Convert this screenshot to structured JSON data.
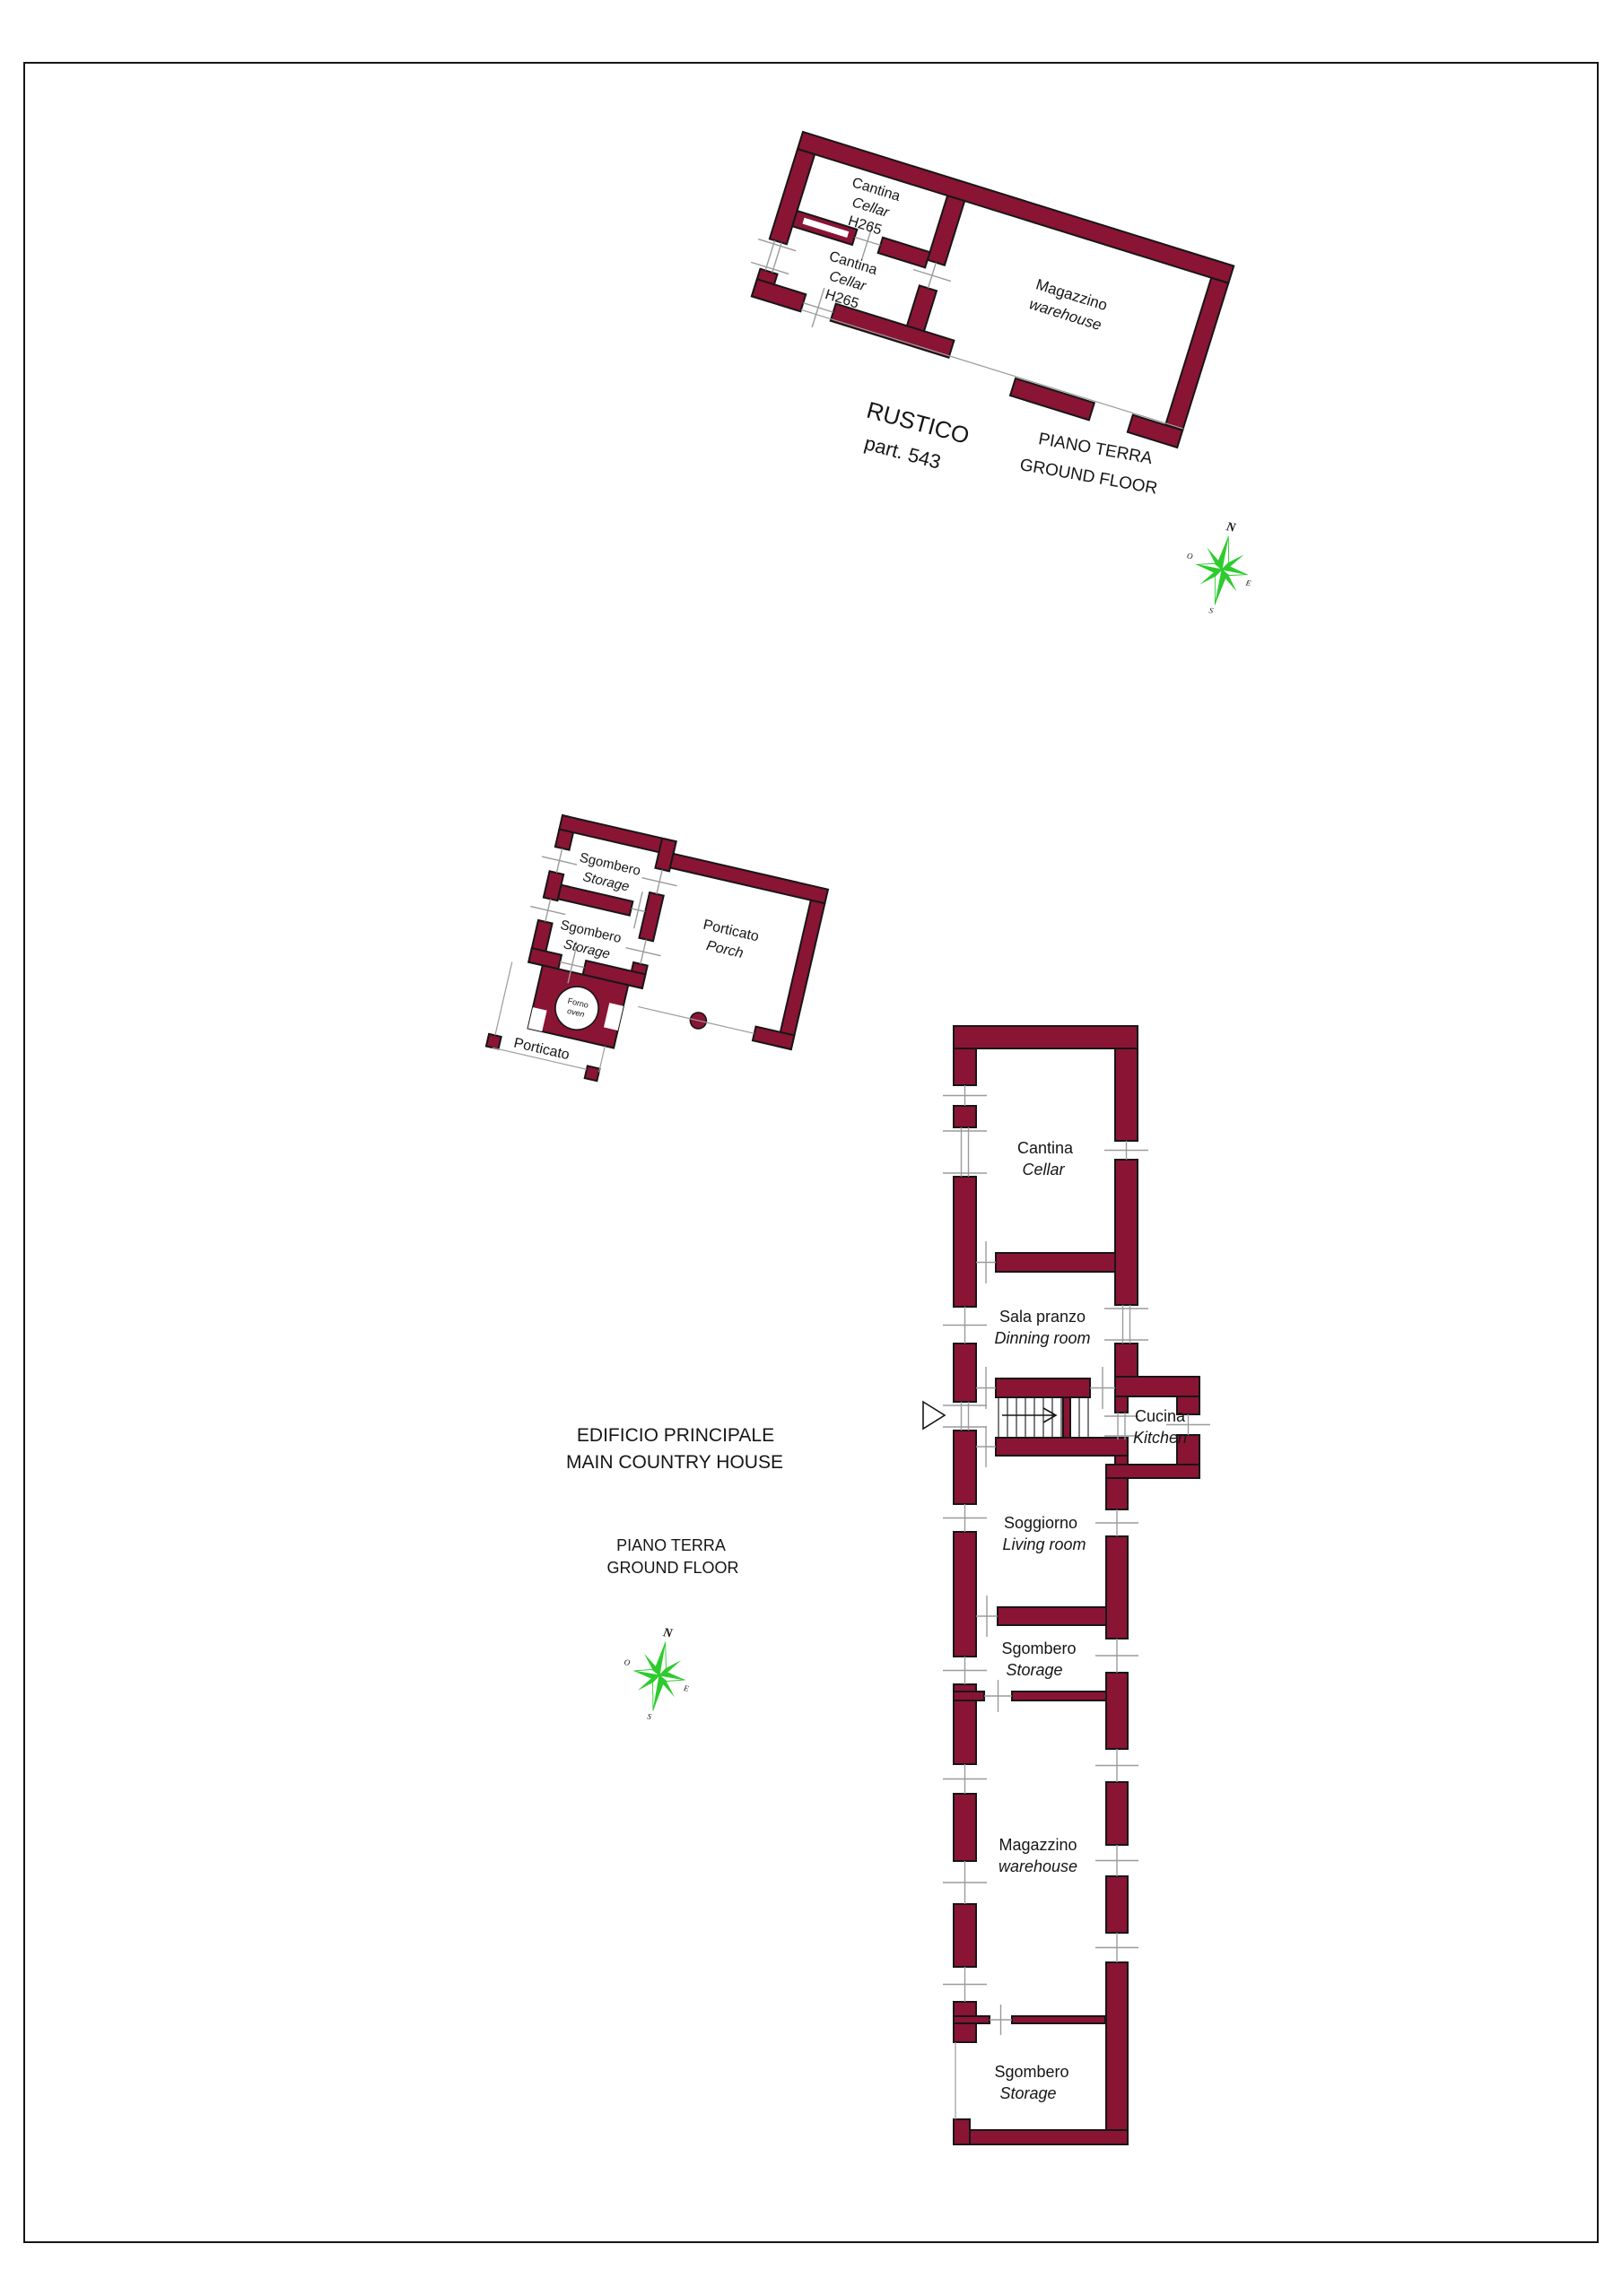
{
  "colors": {
    "wall": "#8a1434",
    "outline": "#161616",
    "thin_line": "#9b9b9b",
    "compass_green": "#2ecb2e",
    "text": "#161616"
  },
  "rustico": {
    "title": "RUSTICO",
    "parcel": "part. 543",
    "floor1": "PIANO TERRA",
    "floor2": "GROUND FLOOR",
    "cantina_upper": {
      "it": "Cantina",
      "en": "Cellar",
      "h": "H265"
    },
    "cantina_lower": {
      "it": "Cantina",
      "en": "Cellar",
      "h": "H265"
    },
    "magazzino": {
      "it": "Magazzino",
      "en": "warehouse"
    }
  },
  "outbuilding": {
    "storage_upper": {
      "it": "Sgombero",
      "en": "Storage"
    },
    "storage_lower": {
      "it": "Sgombero",
      "en": "Storage"
    },
    "porch": {
      "it": "Porticato",
      "en": "Porch"
    },
    "oven": {
      "it": "Forno",
      "en": "oven"
    },
    "porch_open": {
      "it": "Porticato"
    }
  },
  "main_house": {
    "title1": "EDIFICIO PRINCIPALE",
    "title2": "MAIN COUNTRY HOUSE",
    "floor1": "PIANO TERRA",
    "floor2": "GROUND FLOOR",
    "cantina": {
      "it": "Cantina",
      "en": "Cellar"
    },
    "sala_pranzo": {
      "it": "Sala pranzo",
      "en": "Dinning room"
    },
    "cucina": {
      "it": "Cucina",
      "en": "Kitchen"
    },
    "soggiorno": {
      "it": "Soggiorno",
      "en": "Living room"
    },
    "sgombero_mid": {
      "it": "Sgombero",
      "en": "Storage"
    },
    "magazzino": {
      "it": "Magazzino",
      "en": "warehouse"
    },
    "sgombero_bottom": {
      "it": "Sgombero",
      "en": "Storage"
    }
  },
  "compass": {
    "n": "N",
    "e": "E",
    "s": "S",
    "w": "O"
  }
}
